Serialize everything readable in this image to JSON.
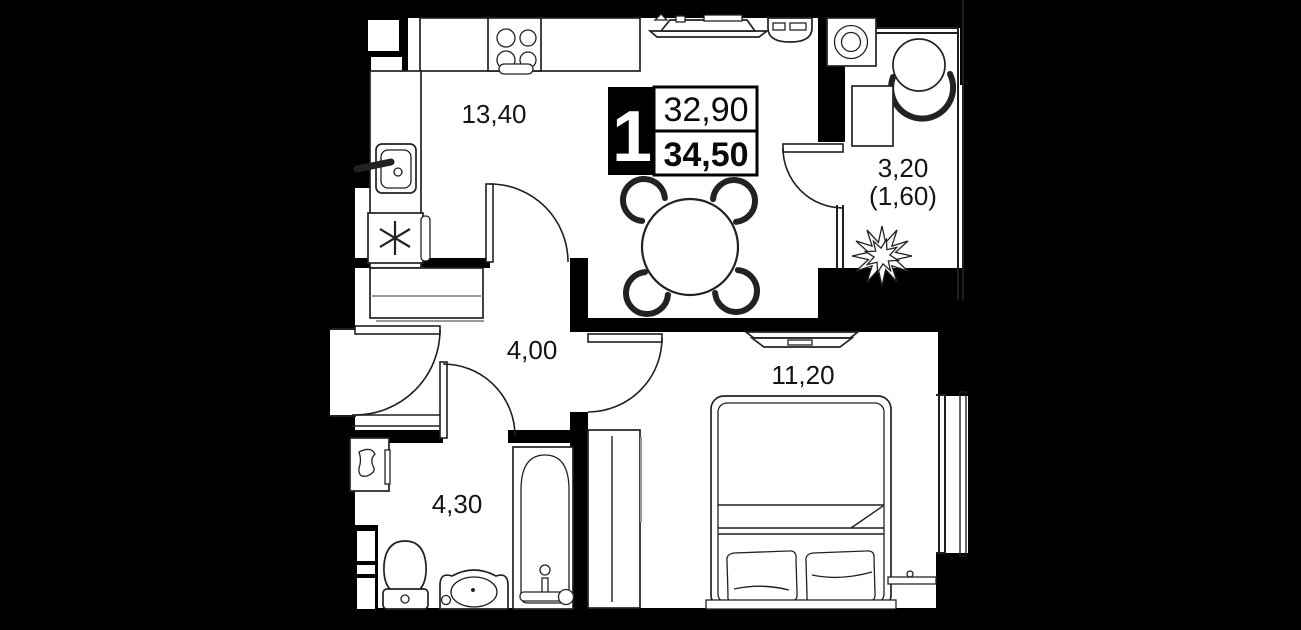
{
  "plan": {
    "title_block": {
      "rooms": "1",
      "area_upper": "32,90",
      "area_lower": "34,50"
    },
    "rooms": {
      "kitchen_living": {
        "area": "13,40"
      },
      "hallway": {
        "area": "4,00"
      },
      "bathroom": {
        "area": "4,30"
      },
      "bedroom": {
        "area": "11,20"
      },
      "balcony": {
        "area": "3,20",
        "area_reduced": "(1,60)"
      }
    },
    "colors": {
      "background": "#000000",
      "wall": "#000000",
      "floor": "#ffffff",
      "line": "#1f1f1f"
    }
  }
}
